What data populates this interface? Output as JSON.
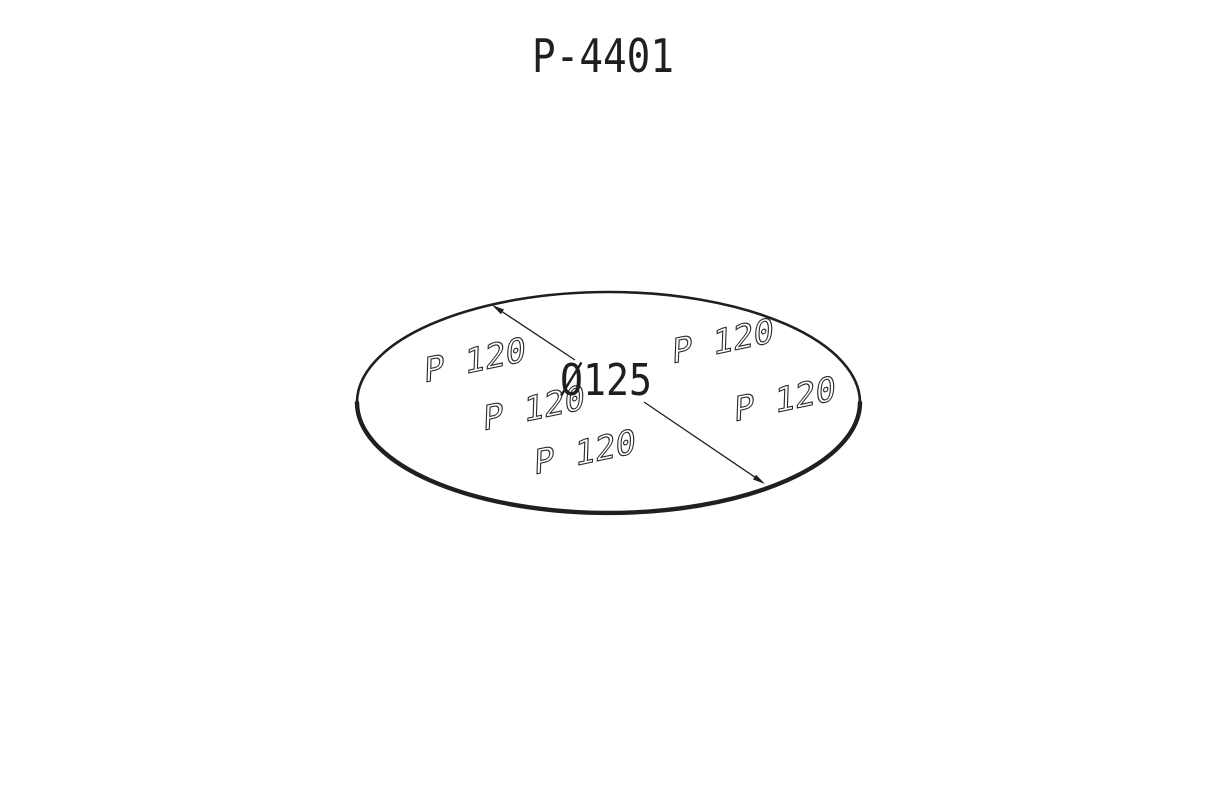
{
  "drawing": {
    "title": "P-4401",
    "part": {
      "name": "abrasive-sanding-disc",
      "diameter_label": "Ø125",
      "grit_labels": [
        "P 120",
        "P 120",
        "P 120",
        "P 120",
        "P 120"
      ]
    },
    "colors": {
      "line": "#1f1f1f",
      "background": "#ffffff",
      "grit_text_fill": "#ffffff"
    }
  }
}
